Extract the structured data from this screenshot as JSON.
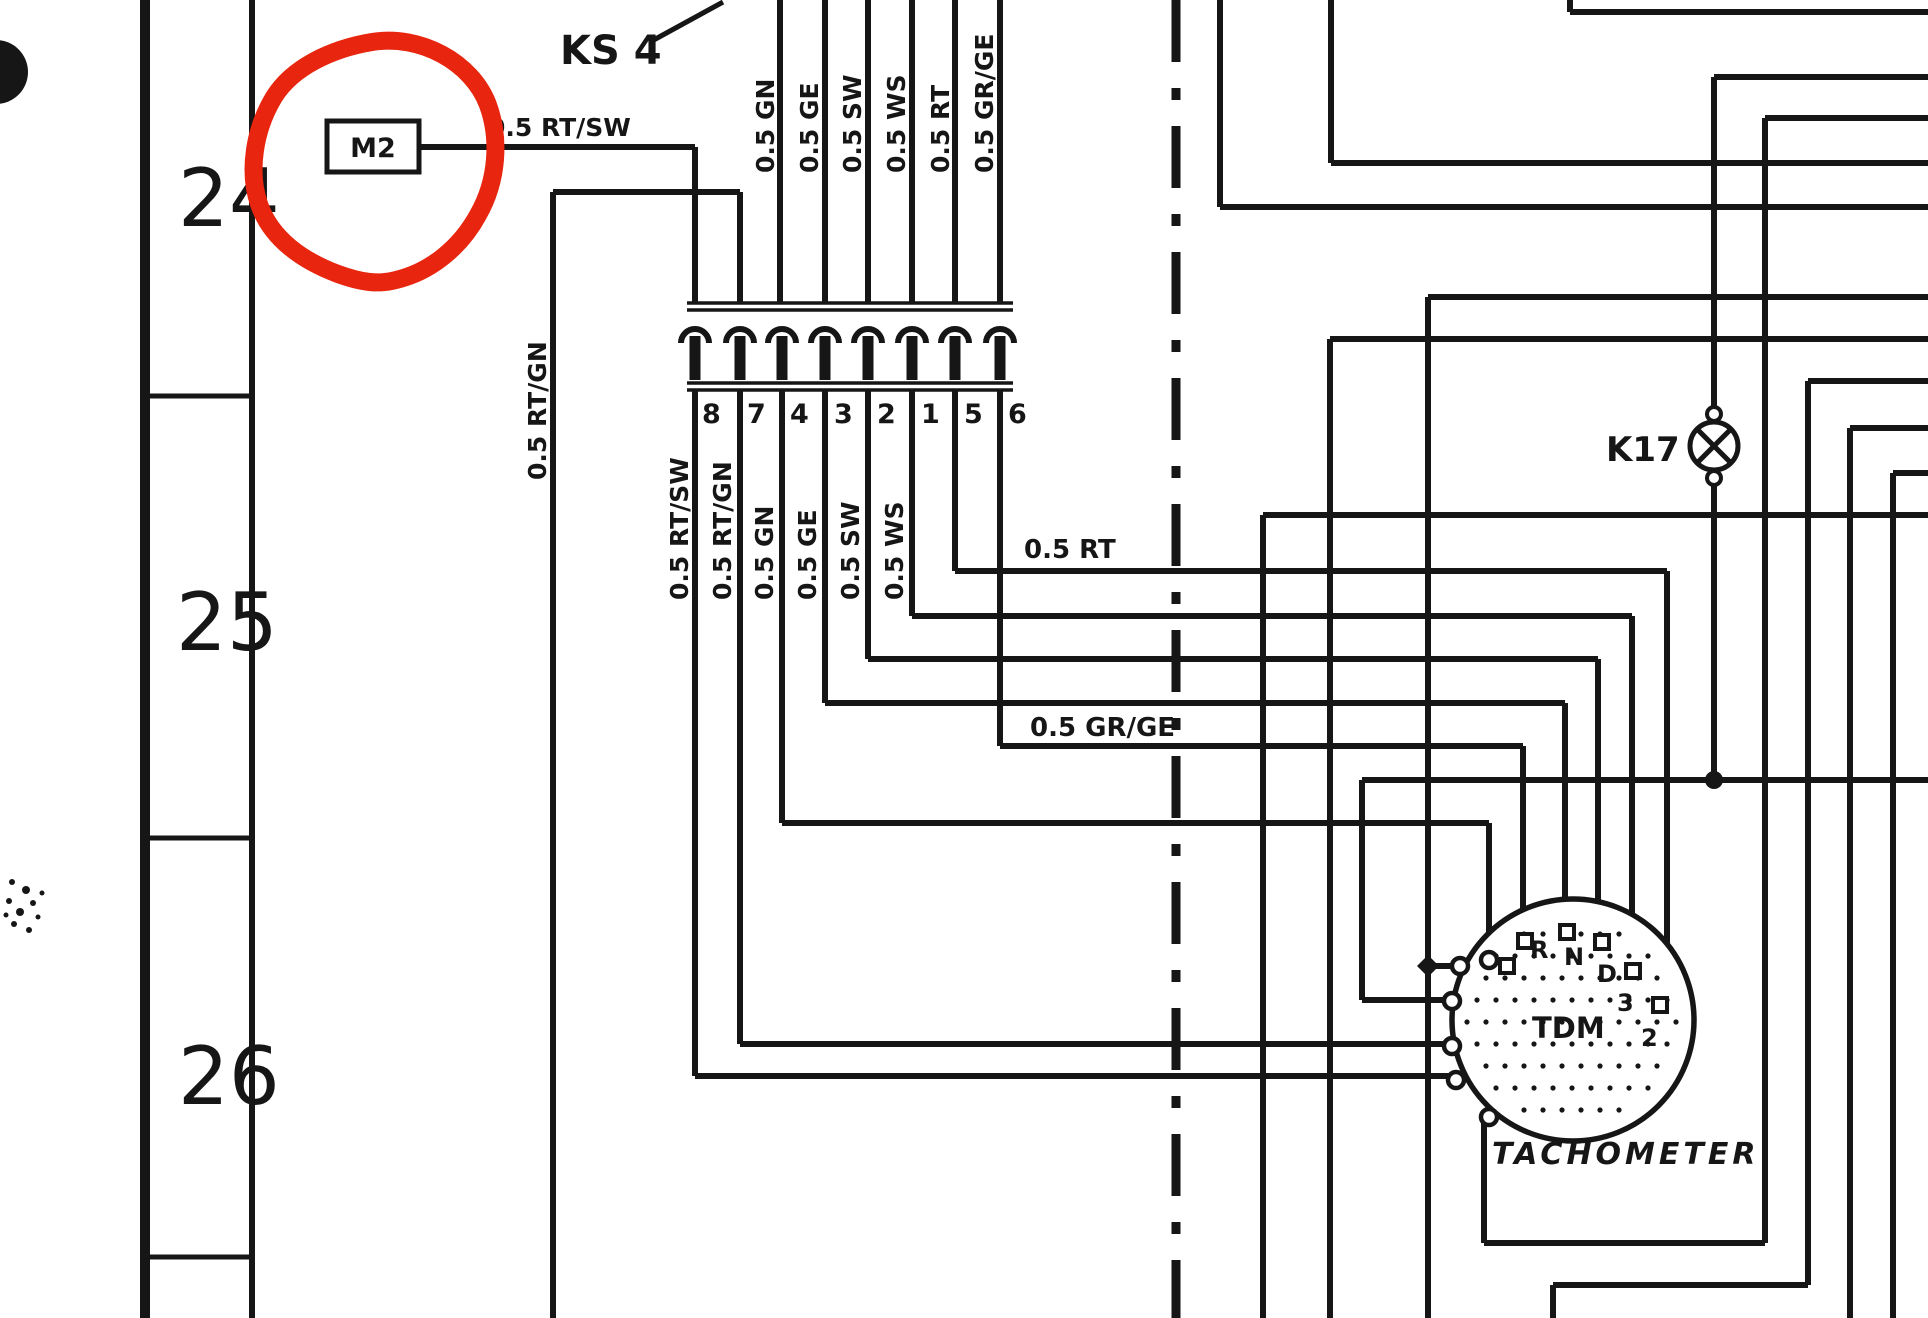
{
  "page": {
    "background": "#ffffff",
    "ink_color": "#161616",
    "annotation_color": "#e8250e",
    "description_labels": {
      "component_m2": "M2",
      "connector_name": "KS 4",
      "lamp_name": "K17",
      "tachometer_title": "TACHOMETER",
      "tachometer_module": "TDM"
    }
  },
  "row_gutter": {
    "rows": [
      {
        "label": "24"
      },
      {
        "label": "25"
      },
      {
        "label": "26"
      }
    ]
  },
  "connector": {
    "pin_numbers": [
      "8",
      "7",
      "4",
      "3",
      "2",
      "1",
      "5",
      "6"
    ]
  },
  "tachometer": {
    "pin_labels": [
      "R",
      "N",
      "D",
      "3",
      "2"
    ]
  },
  "labels": [
    {
      "text": "KS 4",
      "x": 560,
      "y": 64,
      "size": 40,
      "rot": 0,
      "weight": "bold"
    },
    {
      "text": "0.5 RT/SW",
      "x": 488,
      "y": 136,
      "size": 25,
      "rot": 0,
      "weight": "bold"
    },
    {
      "text": "0.5 RT",
      "x": 1024,
      "y": 558,
      "size": 26,
      "rot": 0,
      "weight": "bold"
    },
    {
      "text": "0.5 GR/GE",
      "x": 1030,
      "y": 736,
      "size": 26,
      "rot": 0,
      "weight": "bold"
    },
    {
      "text": "K17",
      "x": 1606,
      "y": 461,
      "size": 34,
      "rot": 0,
      "weight": "bold"
    },
    {
      "text": "0.5 GN",
      "x": 774,
      "y": 173,
      "size": 25,
      "rot": -90,
      "weight": "bold"
    },
    {
      "text": "0.5 GE",
      "x": 818,
      "y": 173,
      "size": 25,
      "rot": -90,
      "weight": "bold"
    },
    {
      "text": "0.5 SW",
      "x": 861,
      "y": 173,
      "size": 25,
      "rot": -90,
      "weight": "bold"
    },
    {
      "text": "0.5 WS",
      "x": 905,
      "y": 173,
      "size": 25,
      "rot": -90,
      "weight": "bold"
    },
    {
      "text": "0.5 RT",
      "x": 949,
      "y": 173,
      "size": 25,
      "rot": -90,
      "weight": "bold"
    },
    {
      "text": "0.5 GR/GE",
      "x": 993,
      "y": 173,
      "size": 25,
      "rot": -90,
      "weight": "bold"
    },
    {
      "text": "0.5 RT/SW",
      "x": 688,
      "y": 600,
      "size": 25,
      "rot": -90,
      "weight": "bold"
    },
    {
      "text": "0.5 RT/GN",
      "x": 731,
      "y": 600,
      "size": 25,
      "rot": -90,
      "weight": "bold"
    },
    {
      "text": "0.5 GN",
      "x": 773,
      "y": 600,
      "size": 25,
      "rot": -90,
      "weight": "bold"
    },
    {
      "text": "0.5 GE",
      "x": 816,
      "y": 600,
      "size": 25,
      "rot": -90,
      "weight": "bold"
    },
    {
      "text": "0.5 SW",
      "x": 859,
      "y": 600,
      "size": 25,
      "rot": -90,
      "weight": "bold"
    },
    {
      "text": "0.5 WS",
      "x": 903,
      "y": 600,
      "size": 25,
      "rot": -90,
      "weight": "bold"
    },
    {
      "text": "0.5 RT/GN",
      "x": 546,
      "y": 480,
      "size": 25,
      "rot": -90,
      "weight": "bold"
    },
    {
      "text": "R",
      "x": 1530,
      "y": 958,
      "size": 24,
      "rot": 0,
      "weight": "bold"
    },
    {
      "text": "N",
      "x": 1564,
      "y": 965,
      "size": 24,
      "rot": 0,
      "weight": "bold"
    },
    {
      "text": "D",
      "x": 1597,
      "y": 982,
      "size": 24,
      "rot": 0,
      "weight": "bold"
    },
    {
      "text": "3",
      "x": 1617,
      "y": 1011,
      "size": 24,
      "rot": 0,
      "weight": "bold"
    },
    {
      "text": "2",
      "x": 1641,
      "y": 1046,
      "size": 24,
      "rot": 0,
      "weight": "bold"
    },
    {
      "text": "TDM",
      "x": 1532,
      "y": 1038,
      "size": 29,
      "rot": 0,
      "weight": "bold"
    },
    {
      "text": "TACHOMETER",
      "x": 1492,
      "y": 1164,
      "size": 30,
      "rot": 0,
      "weight": "bold",
      "italic": true,
      "spacing": 4
    },
    {
      "text": "24",
      "x": 178,
      "y": 226,
      "size": 80,
      "rot": 0,
      "weight": "normal"
    },
    {
      "text": "25",
      "x": 176,
      "y": 650,
      "size": 80,
      "rot": 0,
      "weight": "normal"
    },
    {
      "text": "26",
      "x": 178,
      "y": 1104,
      "size": 80,
      "rot": 0,
      "weight": "normal"
    },
    {
      "text": "8",
      "x": 702,
      "y": 423,
      "size": 27,
      "rot": 0,
      "weight": "bold"
    },
    {
      "text": "7",
      "x": 747,
      "y": 423,
      "size": 27,
      "rot": 0,
      "weight": "bold"
    },
    {
      "text": "4",
      "x": 790,
      "y": 423,
      "size": 27,
      "rot": 0,
      "weight": "bold"
    },
    {
      "text": "3",
      "x": 834,
      "y": 423,
      "size": 27,
      "rot": 0,
      "weight": "bold"
    },
    {
      "text": "2",
      "x": 877,
      "y": 423,
      "size": 27,
      "rot": 0,
      "weight": "bold"
    },
    {
      "text": "1",
      "x": 921,
      "y": 423,
      "size": 27,
      "rot": 0,
      "weight": "bold"
    },
    {
      "text": "5",
      "x": 964,
      "y": 423,
      "size": 27,
      "rot": 0,
      "weight": "bold"
    },
    {
      "text": "6",
      "x": 1008,
      "y": 423,
      "size": 27,
      "rot": 0,
      "weight": "bold"
    }
  ],
  "diagram_geometry": {
    "vertical_wires": [
      {
        "id": "wire-rtgn-long",
        "x": 553,
        "y1": 192,
        "y2": 1318
      },
      {
        "id": "wire-m2-drop",
        "x": 695,
        "y1": 147,
        "y2": 303
      },
      {
        "id": "wire-pin7-top",
        "x": 740,
        "y1": 192,
        "y2": 303
      },
      {
        "id": "wire-gn-top",
        "x": 780,
        "y1": 0,
        "y2": 303
      },
      {
        "id": "wire-ge-top",
        "x": 825,
        "y1": 0,
        "y2": 303
      },
      {
        "id": "wire-sw-top",
        "x": 868,
        "y1": 0,
        "y2": 303
      },
      {
        "id": "wire-ws-top",
        "x": 912,
        "y1": 0,
        "y2": 303
      },
      {
        "id": "wire-rt-top",
        "x": 955,
        "y1": 0,
        "y2": 303
      },
      {
        "id": "wire-grge-top",
        "x": 1000,
        "y1": 0,
        "y2": 303
      },
      {
        "id": "wire-pin8-down",
        "x": 695,
        "y1": 390,
        "y2": 1076
      },
      {
        "id": "wire-pin7-down",
        "x": 740,
        "y1": 390,
        "y2": 1044
      },
      {
        "id": "wire-pin4-down",
        "x": 782,
        "y1": 390,
        "y2": 823
      },
      {
        "id": "wire-pin3-down",
        "x": 825,
        "y1": 390,
        "y2": 703
      },
      {
        "id": "wire-pin2-down",
        "x": 868,
        "y1": 390,
        "y2": 659
      },
      {
        "id": "wire-pin1-down",
        "x": 912,
        "y1": 390,
        "y2": 616
      },
      {
        "id": "wire-pin5-down",
        "x": 955,
        "y1": 390,
        "y2": 571
      },
      {
        "id": "wire-pin6-down",
        "x": 1000,
        "y1": 390,
        "y2": 746
      },
      {
        "id": "bus-v1",
        "x": 1220,
        "y1": 0,
        "y2": 207
      },
      {
        "id": "bus-v2",
        "x": 1331,
        "y1": 0,
        "y2": 163
      },
      {
        "id": "bus-v3",
        "x": 1570,
        "y1": 0,
        "y2": 12
      },
      {
        "id": "k17-wire-top",
        "x": 1714,
        "y1": 77,
        "y2": 408
      },
      {
        "id": "k17-wire-bottom",
        "x": 1714,
        "y1": 484,
        "y2": 780
      },
      {
        "id": "bus-v4",
        "x": 1765,
        "y1": 118,
        "y2": 1243
      },
      {
        "id": "bus-v5",
        "x": 1263,
        "y1": 515,
        "y2": 1318
      },
      {
        "id": "bus-v6",
        "x": 1330,
        "y1": 339,
        "y2": 1318
      },
      {
        "id": "bus-v7-diamond",
        "x": 1428,
        "y1": 297,
        "y2": 1318
      },
      {
        "id": "tach-pin2-riser",
        "x": 1362,
        "y1": 780,
        "y2": 1000
      },
      {
        "id": "tach-wire-rt",
        "x": 1667,
        "y1": 571,
        "y2": 1000
      },
      {
        "id": "tach-wire-ws",
        "x": 1632,
        "y1": 616,
        "y2": 966
      },
      {
        "id": "tach-wire-sw",
        "x": 1598,
        "y1": 659,
        "y2": 937
      },
      {
        "id": "tach-wire-ge",
        "x": 1565,
        "y1": 703,
        "y2": 927
      },
      {
        "id": "tach-wire-grge",
        "x": 1523,
        "y1": 746,
        "y2": 936
      },
      {
        "id": "tach-wire-gn",
        "x": 1489,
        "y1": 823,
        "y2": 955
      },
      {
        "id": "bus-v8",
        "x": 1808,
        "y1": 381,
        "y2": 1285
      },
      {
        "id": "bus-v9",
        "x": 1850,
        "y1": 428,
        "y2": 1318
      },
      {
        "id": "bus-v10",
        "x": 1893,
        "y1": 473,
        "y2": 1318
      },
      {
        "id": "bus-v11",
        "x": 1553,
        "y1": 1285,
        "y2": 1318
      },
      {
        "id": "tach-box-left",
        "x": 1484,
        "y1": 1122,
        "y2": 1243
      }
    ],
    "horizontal_wires": [
      {
        "id": "m2-wire",
        "y": 147,
        "x1": 418,
        "x2": 695
      },
      {
        "id": "rtgn-bridge",
        "y": 192,
        "x1": 553,
        "x2": 740
      },
      {
        "id": "bus-h1",
        "y": 12,
        "x1": 1570,
        "x2": 1928
      },
      {
        "id": "bus-h2",
        "y": 77,
        "x1": 1714,
        "x2": 1928
      },
      {
        "id": "bus-h3",
        "y": 118,
        "x1": 1765,
        "x2": 1928
      },
      {
        "id": "bus-h4",
        "y": 163,
        "x1": 1331,
        "x2": 1928
      },
      {
        "id": "bus-h5",
        "y": 207,
        "x1": 1220,
        "x2": 1928
      },
      {
        "id": "bus-h6",
        "y": 297,
        "x1": 1428,
        "x2": 1928
      },
      {
        "id": "bus-h7",
        "y": 339,
        "x1": 1330,
        "x2": 1928
      },
      {
        "id": "bus-h8",
        "y": 381,
        "x1": 1808,
        "x2": 1928
      },
      {
        "id": "bus-h9",
        "y": 428,
        "x1": 1850,
        "x2": 1928
      },
      {
        "id": "bus-h10",
        "y": 473,
        "x1": 1893,
        "x2": 1928
      },
      {
        "id": "bus-h11",
        "y": 515,
        "x1": 1263,
        "x2": 1928
      },
      {
        "id": "wire-rt-run",
        "y": 571,
        "x1": 955,
        "x2": 1667
      },
      {
        "id": "wire-ws-run",
        "y": 616,
        "x1": 912,
        "x2": 1632
      },
      {
        "id": "wire-sw-run",
        "y": 659,
        "x1": 868,
        "x2": 1598
      },
      {
        "id": "wire-ge-run",
        "y": 703,
        "x1": 825,
        "x2": 1565
      },
      {
        "id": "wire-grge-run",
        "y": 746,
        "x1": 1000,
        "x2": 1523
      },
      {
        "id": "k17-run",
        "y": 780,
        "x1": 1362,
        "x2": 1928
      },
      {
        "id": "wire-gn-run",
        "y": 823,
        "x1": 782,
        "x2": 1489
      },
      {
        "id": "tach-pin2-stub",
        "y": 1000,
        "x1": 1362,
        "x2": 1448
      },
      {
        "id": "diamond-stub",
        "y": 966,
        "x1": 1428,
        "x2": 1456
      },
      {
        "id": "wire-rtgn-run",
        "y": 1044,
        "x1": 740,
        "x2": 1450
      },
      {
        "id": "wire-rtsw-run",
        "y": 1076,
        "x1": 695,
        "x2": 1452
      },
      {
        "id": "bus-h12",
        "y": 1285,
        "x1": 1553,
        "x2": 1808
      },
      {
        "id": "tach-box-bottom",
        "y": 1243,
        "x1": 1484,
        "x2": 1765
      }
    ],
    "connector": {
      "rail_x1": 687,
      "rail_x2": 1013,
      "rail_ys": [
        303,
        310,
        383,
        390
      ],
      "pin_xs": [
        695,
        740,
        782,
        825,
        868,
        912,
        955,
        1000
      ]
    },
    "dash_dot_line": {
      "x": 1176,
      "dash": [
        62,
        26,
        12,
        26
      ],
      "width": 9
    },
    "gutter": {
      "outer_x": 145,
      "inner_x": 252,
      "dividers_y": [
        396,
        838,
        1257
      ]
    },
    "m2_box": {
      "x": 327,
      "y": 121,
      "w": 92,
      "h": 51
    },
    "ks4_leader": {
      "x1": 650,
      "y1": 42,
      "x2": 723,
      "y2": 2
    },
    "k17_lamp": {
      "cx": 1714,
      "cy": 446,
      "r": 24,
      "terminal_r": 7,
      "junction_dot": [
        1714,
        780
      ]
    },
    "diamond_junction": {
      "x": 1428,
      "y": 966
    },
    "tach": {
      "cx": 1573,
      "cy": 1020,
      "r": 121,
      "top_pin_circle": [
        1489,
        960
      ],
      "pin_squares": [
        [
          1507,
          966
        ],
        [
          1525,
          941
        ],
        [
          1567,
          932
        ],
        [
          1602,
          942
        ],
        [
          1633,
          971
        ],
        [
          1660,
          1005
        ]
      ],
      "left_pin_circles": [
        [
          1460,
          966
        ],
        [
          1452,
          1001
        ],
        [
          1452,
          1046
        ],
        [
          1456,
          1080
        ],
        [
          1489,
          1117
        ]
      ],
      "pin_label_refs": [
        "R",
        "N",
        "D",
        "3",
        "2"
      ]
    }
  }
}
